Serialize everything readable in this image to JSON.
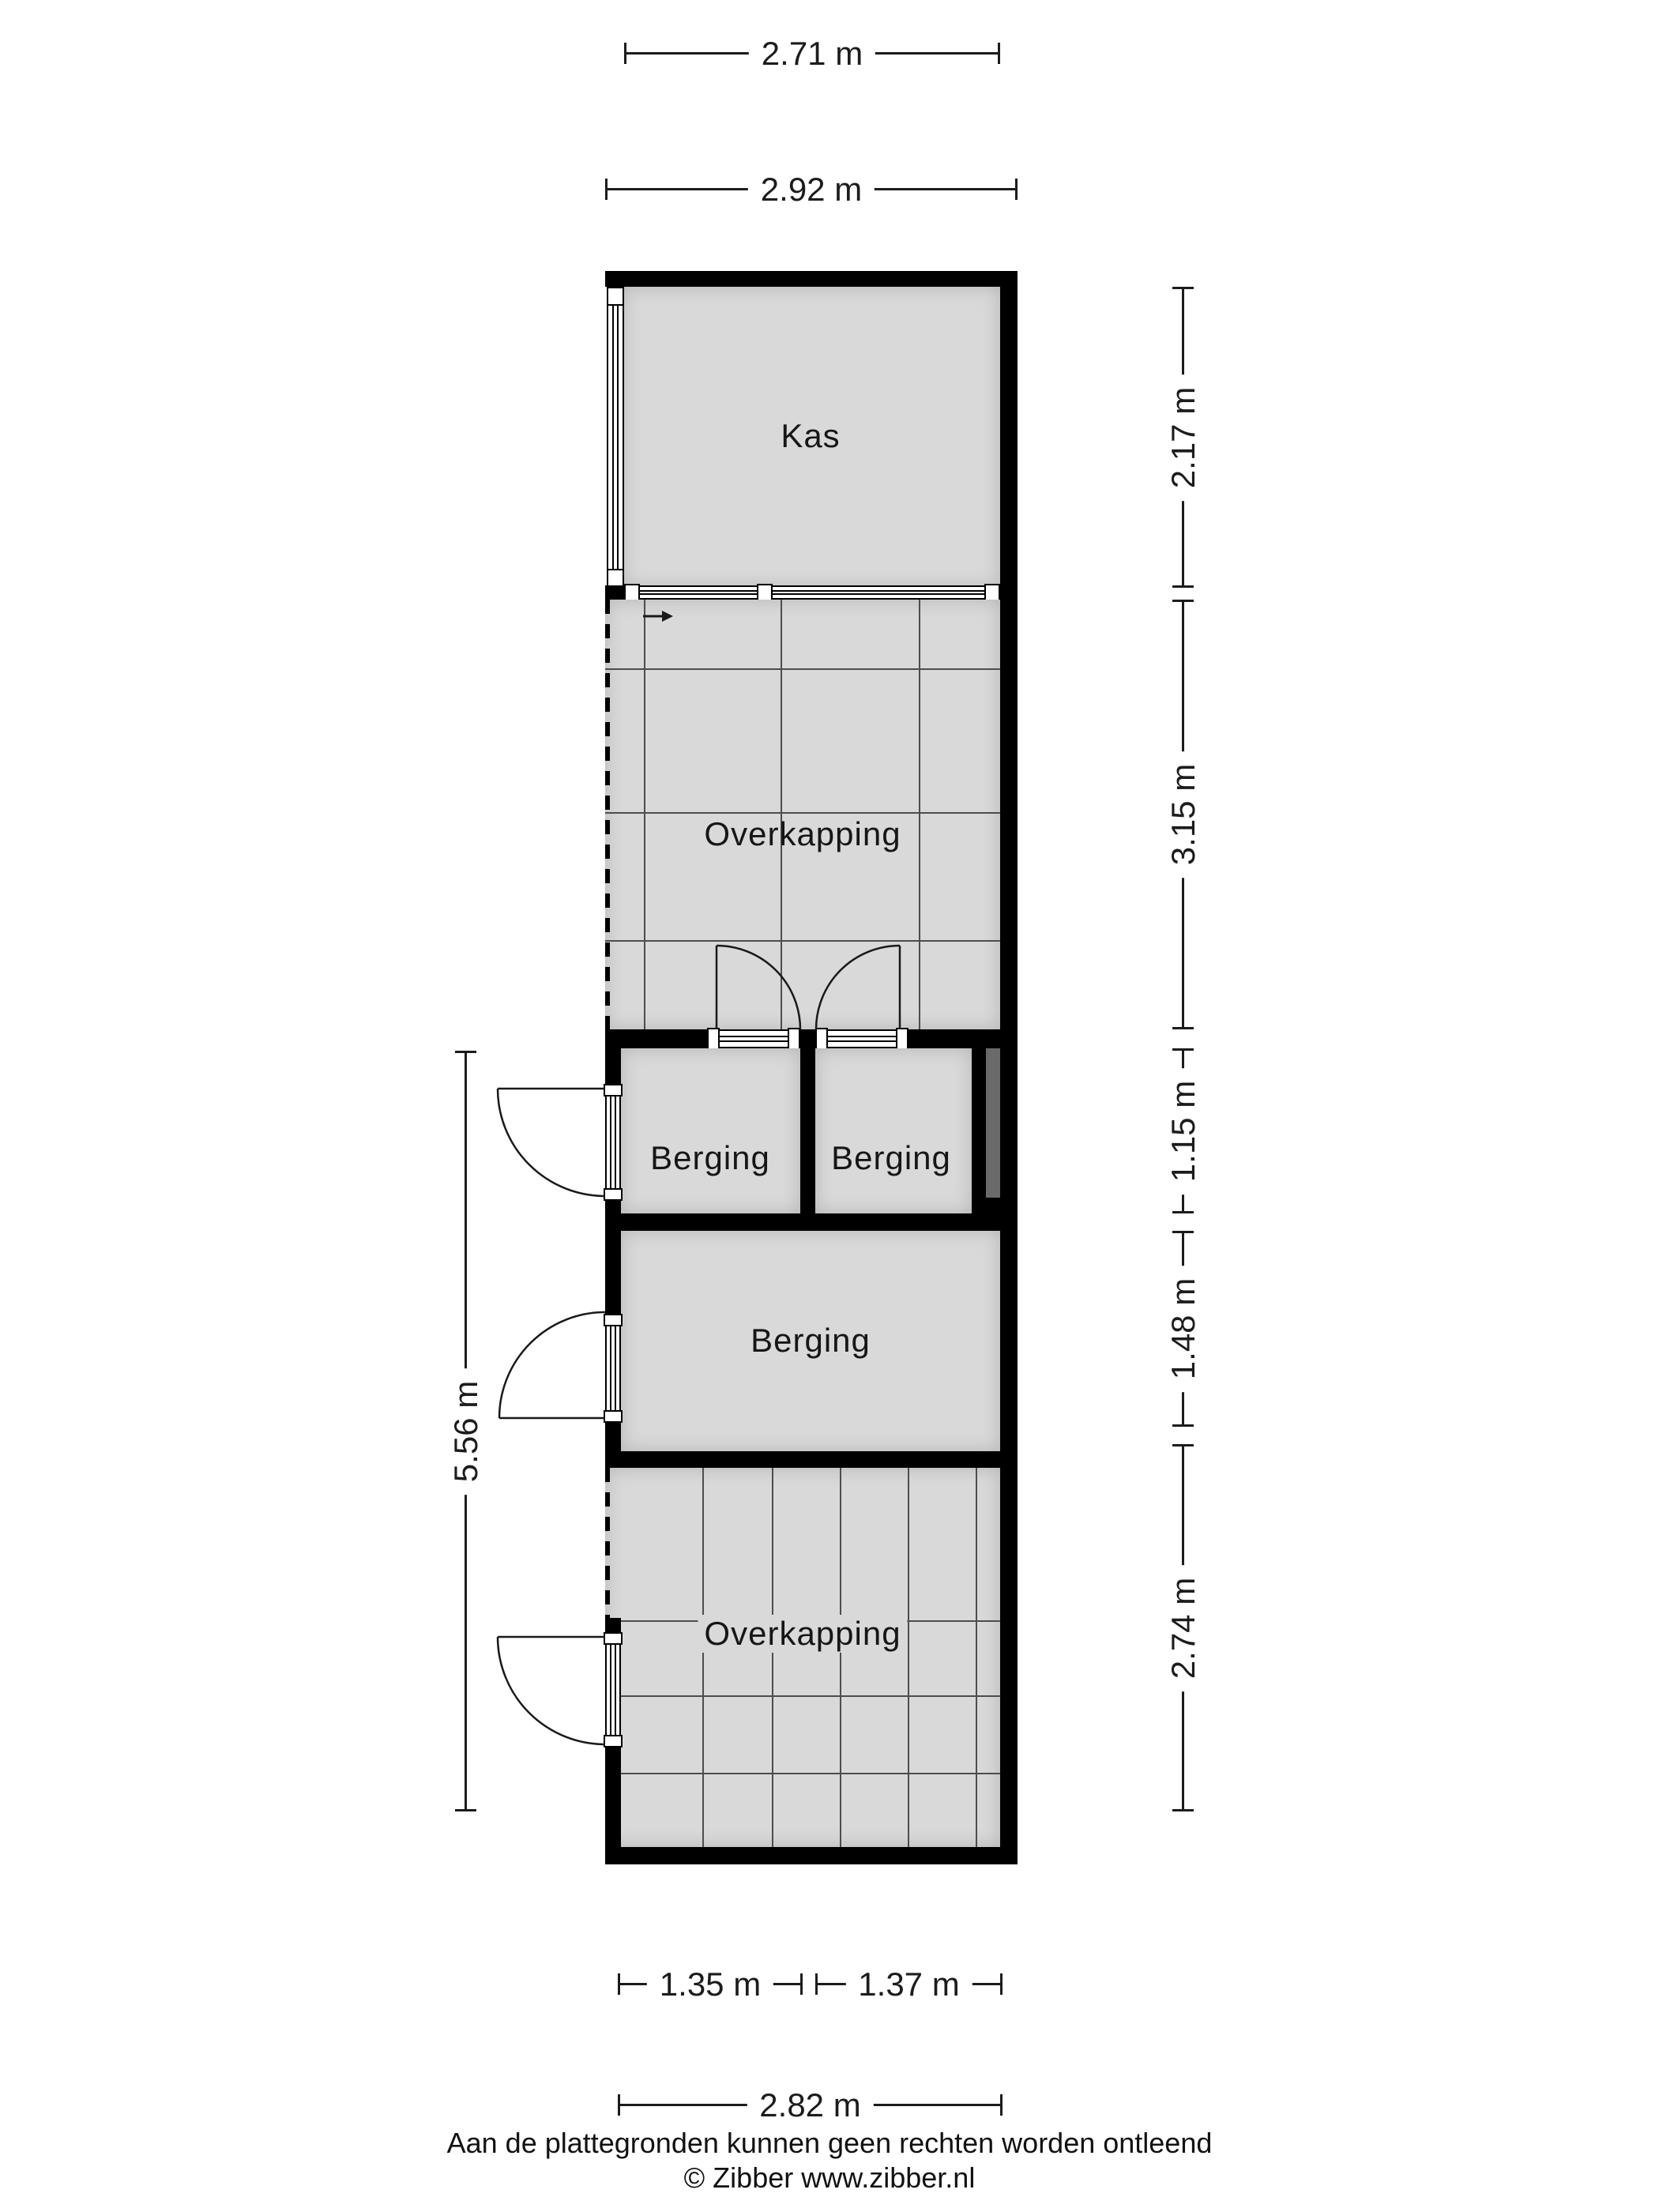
{
  "plan": {
    "rooms": [
      {
        "label": "Kas"
      },
      {
        "label": "Overkapping"
      },
      {
        "label": "Berging"
      },
      {
        "label": "Berging"
      },
      {
        "label": "Berging"
      },
      {
        "label": "Overkapping"
      }
    ],
    "dimensions": {
      "top": [
        "2.71 m",
        "2.92 m"
      ],
      "right": [
        "2.17 m",
        "3.15 m",
        "1.15 m",
        "1.48 m",
        "2.74 m"
      ],
      "left": [
        "5.56 m"
      ],
      "bottom": [
        "1.35 m",
        "1.37 m",
        "2.82 m"
      ]
    },
    "icons": [
      {
        "name": "entrance-arrow-icon"
      }
    ],
    "colors": {
      "wall": "#000000",
      "room_fill": "#d9d9d9",
      "shaft_fill": "#6a6a6a",
      "grid_line": "#4d4d4d",
      "dimension_text": "#1c1c1c"
    }
  },
  "footer": {
    "disclaimer": "Aan de plattegronden kunnen geen rechten worden ontleend",
    "credit": "© Zibber www.zibber.nl"
  }
}
